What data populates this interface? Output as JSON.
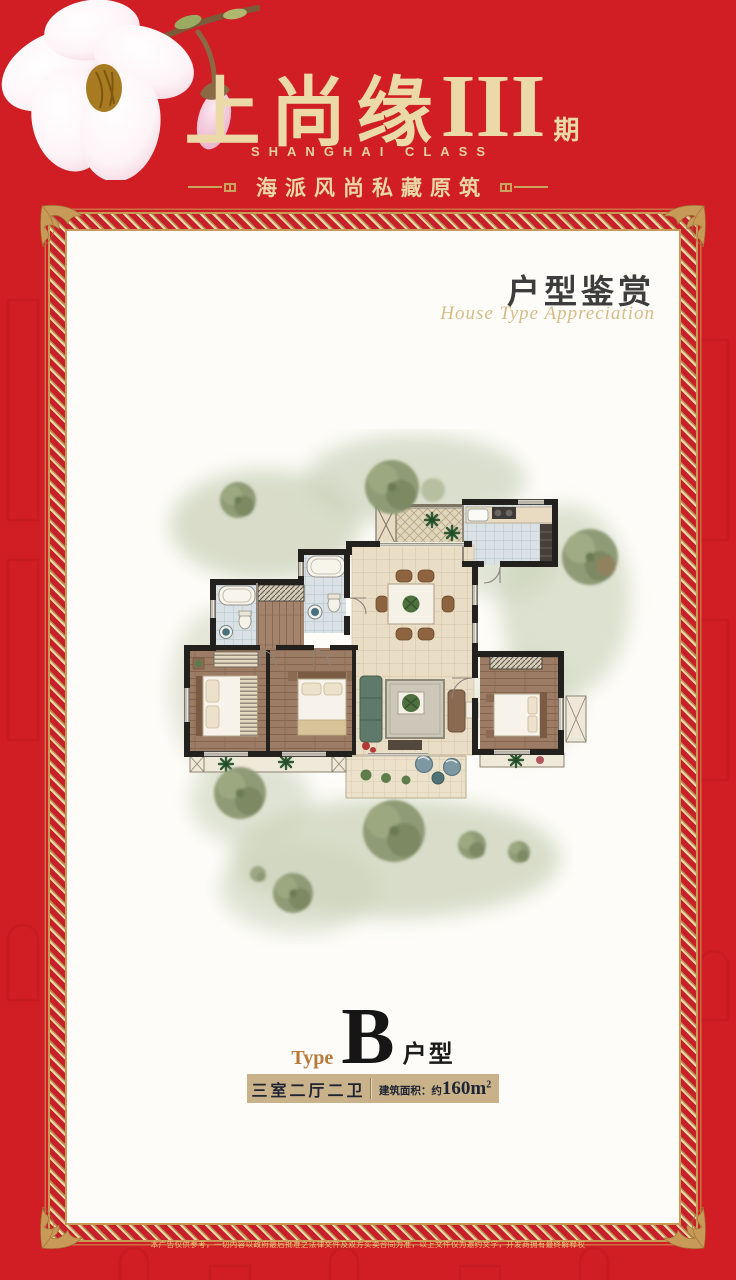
{
  "header": {
    "title_cn": "上尚缘",
    "title_numeral": "III",
    "title_suffix": "期",
    "subtitle_en": "SHANGHAI CLASS",
    "tagline": "海派风尚私藏原筑"
  },
  "card": {
    "section": {
      "title_cn": "户型鉴赏",
      "title_en": "House Type Appreciation"
    },
    "type": {
      "label": "Type",
      "letter": "B",
      "suffix": "户型"
    },
    "specs": {
      "rooms": "三室二厅二卫",
      "area_label": "建筑面积：约",
      "area_value": "160m",
      "area_sup": "2"
    }
  },
  "footer": {
    "disclaimer": "本广告仅供参考，一切内容以政府最后批准之法律文件及双方买卖合同为准，以上文件仅为邀约文字，开发商拥有最终解释权"
  },
  "icons": {
    "flower": "magnolia-blossom",
    "corner": "acanthus-leaf-flourish",
    "tagline_ornament": "line-and-plug",
    "trees": "watercolor-tree"
  },
  "colors": {
    "brand_red": "#d01e24",
    "gold_text": "#ecd9a8",
    "border_gold": "#c79a58",
    "bar_tan": "#c9b28a",
    "ink": "#1e2433"
  }
}
